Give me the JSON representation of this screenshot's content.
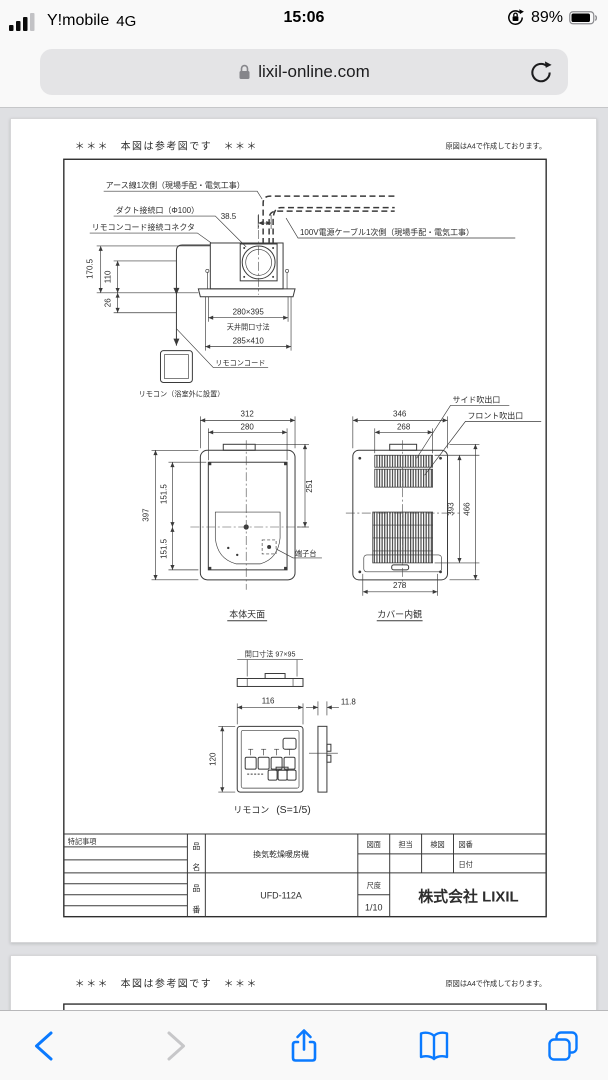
{
  "status_bar": {
    "carrier": "Y!mobile",
    "network": "4G",
    "time": "15:06",
    "battery_percent": "89%"
  },
  "url_bar": {
    "domain": "lixil-online.com"
  },
  "colors": {
    "accent_blue": "#0a7aff",
    "page_bg": "#dfe0e3",
    "line": "#3a3a3a"
  },
  "sheet": {
    "ref_note": "＊＊＊　本図は参考図です　＊＊＊",
    "a4_note": "原図はA4で作成しております。",
    "side_view": {
      "label_earth": "アース線1次側（現場手配・電気工事）",
      "label_duct": "ダクト接続口（Φ100）",
      "label_remote_connector": "リモコンコード接続コネクタ",
      "label_power": "100V電源ケーブル1次側（現場手配・電気工事）",
      "dim_38_5": "38.5",
      "dim_170_5": "170.5",
      "dim_110": "110",
      "dim_26": "26",
      "dim_280x395": "280×395",
      "label_ceiling_opening": "天井開口寸法",
      "dim_285x410": "285×410",
      "label_remote_cord": "リモコンコード",
      "label_remote": "リモコン（浴室外に設置）"
    },
    "top_view": {
      "dim_312": "312",
      "dim_280": "280",
      "dim_397": "397",
      "dim_151_5_upper": "151.5",
      "dim_151_5_lower": "151.5",
      "dim_251": "251",
      "label_terminal": "端子台",
      "caption": "本体天面"
    },
    "cover_view": {
      "label_side_outlet": "サイド吹出口",
      "label_front_outlet": "フロント吹出口",
      "dim_346": "346",
      "dim_268": "268",
      "dim_393": "393",
      "dim_466": "466",
      "dim_278": "278",
      "caption": "カバー内観"
    },
    "remote_view": {
      "dim_opening": "開口寸法 97×95",
      "dim_116": "116",
      "dim_11_8": "11.8",
      "dim_120": "120",
      "caption_name": "リモコン",
      "caption_scale": "(S=1/5)"
    },
    "title_block": {
      "notes_header": "特記事項",
      "name_label_top": "品",
      "name_label_bottom": "名",
      "name_value": "換気乾燥暖房機",
      "number_label_top": "品",
      "number_label_bottom": "番",
      "number_value": "UFD-112A",
      "col_drawing": "図面",
      "col_charge": "担当",
      "col_check": "検図",
      "col_number": "図番",
      "col_date": "日付",
      "scale_label": "尺度",
      "scale_value": "1/10",
      "company": "株式会社 LIXIL"
    }
  },
  "sheet2": {
    "ref_note": "＊＊＊　本図は参考図です　＊＊＊",
    "a4_note": "原図はA4で作成しております。"
  }
}
